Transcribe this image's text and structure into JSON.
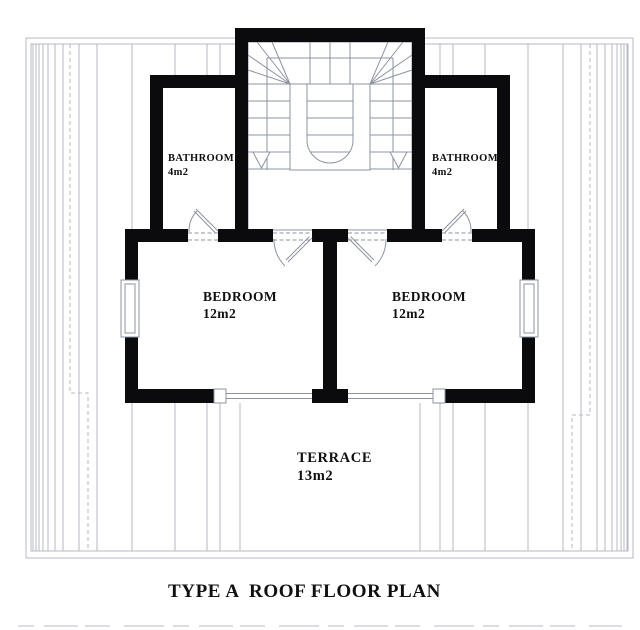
{
  "title": {
    "type_label": "TYPE A",
    "plan_label": "ROOF FLOOR PLAN"
  },
  "rooms": {
    "bathroom_left": {
      "name": "BATHROOM",
      "area": "4m2"
    },
    "bathroom_right": {
      "name": "BATHROOM",
      "area": "4m2"
    },
    "bedroom_left": {
      "name": "BEDROOM",
      "area": "12m2"
    },
    "bedroom_right": {
      "name": "BEDROOM",
      "area": "12m2"
    },
    "terrace": {
      "name": "TERRACE",
      "area": "13m2"
    }
  },
  "colors": {
    "wall": "#0b0b0d",
    "thin_line": "#8d93a0",
    "roof_line": "#b6bac4",
    "text": "#101010",
    "background": "#ffffff",
    "faint": "#dcdce2"
  }
}
